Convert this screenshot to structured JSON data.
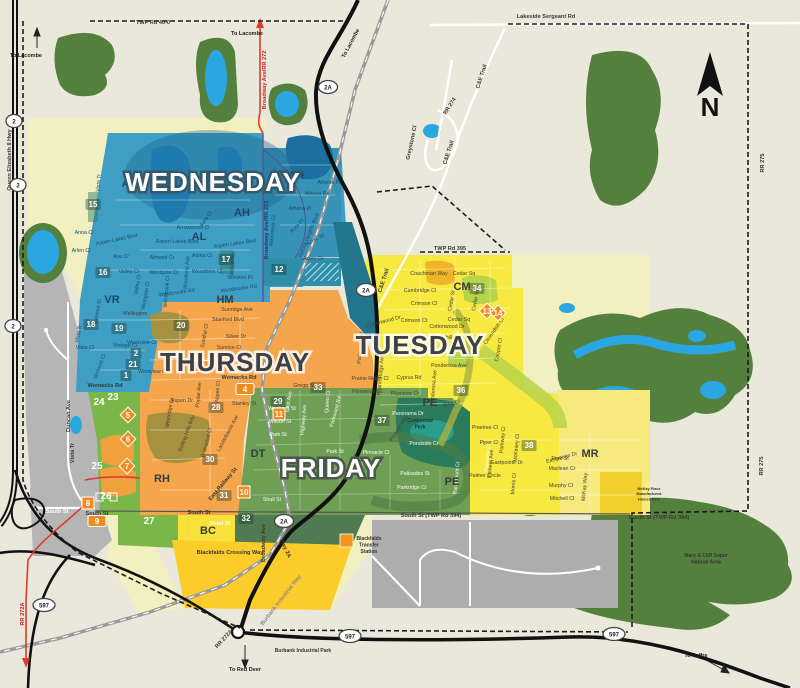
{
  "days": {
    "wednesday": "WEDNESDAY",
    "thursday": "THURSDAY",
    "tuesday": "TUESDAY",
    "friday": "FRIDAY"
  },
  "compass_label": "N",
  "colors": {
    "wednesday_blue": "#3f9ec3",
    "thursday_orange": "#f5a54b",
    "tuesday_yellow": "#f7e93f",
    "friday_green": "#6f9f55",
    "outside_pale": "#f2efc0",
    "county_gray": "#b5b5b5",
    "forest_green": "#54803e",
    "water_blue": "#2aa7e0",
    "marker_orange": "#f28b1f",
    "road_red": "#e03a2f"
  },
  "district_labels": [
    {
      "t": "AL",
      "x": 129,
      "y": 187,
      "c": "navy"
    },
    {
      "t": "AL",
      "x": 199,
      "y": 240,
      "c": "navy"
    },
    {
      "t": "AH",
      "x": 296,
      "y": 179,
      "c": "navy"
    },
    {
      "t": "AH",
      "x": 242,
      "y": 216,
      "c": "navy"
    },
    {
      "t": "VR",
      "x": 112,
      "y": 303,
      "c": "navy"
    },
    {
      "t": "HM",
      "x": 225,
      "y": 303,
      "c": "dark"
    },
    {
      "t": "CM",
      "x": 462,
      "y": 290,
      "c": "dark"
    },
    {
      "t": "RH",
      "x": 162,
      "y": 482,
      "c": "dark"
    },
    {
      "t": "DT",
      "x": 258,
      "y": 457,
      "c": "dark"
    },
    {
      "t": "PE",
      "x": 430,
      "y": 406,
      "c": "dark"
    },
    {
      "t": "PE",
      "x": 452,
      "y": 485,
      "c": "dark"
    },
    {
      "t": "MR",
      "x": 590,
      "y": 457,
      "c": "dark"
    },
    {
      "t": "BC",
      "x": 208,
      "y": 534,
      "c": "dark"
    }
  ],
  "zone_badges": [
    {
      "n": "15",
      "x": 93,
      "y": 207,
      "k": "sq"
    },
    {
      "n": "16",
      "x": 103,
      "y": 275,
      "k": "sq"
    },
    {
      "n": "17",
      "x": 226,
      "y": 262,
      "k": "sq"
    },
    {
      "n": "12",
      "x": 279,
      "y": 272,
      "k": "sq"
    },
    {
      "n": "18",
      "x": 91,
      "y": 327,
      "k": "sq"
    },
    {
      "n": "19",
      "x": 119,
      "y": 331,
      "k": "sq"
    },
    {
      "n": "20",
      "x": 181,
      "y": 328,
      "k": "sq"
    },
    {
      "n": "2",
      "x": 136,
      "y": 356,
      "k": "sq"
    },
    {
      "n": "21",
      "x": 133,
      "y": 367,
      "k": "sq"
    },
    {
      "n": "1",
      "x": 126,
      "y": 378,
      "k": "sq"
    },
    {
      "n": "23",
      "x": 113,
      "y": 400,
      "k": "plain"
    },
    {
      "n": "24",
      "x": 99,
      "y": 405,
      "k": "plain"
    },
    {
      "n": "25",
      "x": 97,
      "y": 469,
      "k": "plain"
    },
    {
      "n": "26",
      "x": 106,
      "y": 499,
      "k": "plain"
    },
    {
      "n": "27",
      "x": 149,
      "y": 524,
      "k": "plain"
    },
    {
      "n": "28",
      "x": 216,
      "y": 410,
      "k": "sq"
    },
    {
      "n": "30",
      "x": 210,
      "y": 462,
      "k": "sq"
    },
    {
      "n": "31",
      "x": 224,
      "y": 498,
      "k": "sq"
    },
    {
      "n": "32",
      "x": 246,
      "y": 521,
      "k": "sq"
    },
    {
      "n": "33",
      "x": 318,
      "y": 390,
      "k": "sq"
    },
    {
      "n": "29",
      "x": 278,
      "y": 404,
      "k": "sq"
    },
    {
      "n": "34",
      "x": 477,
      "y": 291,
      "k": "sq"
    },
    {
      "n": "36",
      "x": 461,
      "y": 393,
      "k": "sq"
    },
    {
      "n": "37",
      "x": 382,
      "y": 423,
      "k": "sq"
    },
    {
      "n": "38",
      "x": 529,
      "y": 448,
      "k": "sq"
    },
    {
      "n": "11",
      "x": 279,
      "y": 417,
      "k": "os"
    },
    {
      "n": "10",
      "x": 244,
      "y": 495,
      "k": "os"
    },
    {
      "n": "8",
      "x": 88,
      "y": 506,
      "k": "os"
    },
    {
      "n": "9",
      "x": 97,
      "y": 524,
      "k": "or"
    },
    {
      "n": "3",
      "x": 202,
      "y": 369,
      "k": "or"
    },
    {
      "n": "4",
      "x": 245,
      "y": 392,
      "k": "or"
    },
    {
      "n": "5",
      "x": 128,
      "y": 418,
      "k": "od"
    },
    {
      "n": "6",
      "x": 128,
      "y": 442,
      "k": "od"
    },
    {
      "n": "7",
      "x": 127,
      "y": 469,
      "k": "od"
    },
    {
      "n": "13",
      "x": 487,
      "y": 314,
      "k": "od"
    },
    {
      "n": "14",
      "x": 498,
      "y": 316,
      "k": "od"
    }
  ],
  "highway_shields": [
    {
      "t": "2",
      "x": 14,
      "y": 123
    },
    {
      "t": "2",
      "x": 18,
      "y": 187
    },
    {
      "t": "2",
      "x": 13,
      "y": 328
    },
    {
      "t": "2A",
      "x": 328,
      "y": 89
    },
    {
      "t": "2A",
      "x": 366,
      "y": 292
    },
    {
      "t": "2A",
      "x": 284,
      "y": 523
    },
    {
      "t": "597",
      "x": 44,
      "y": 607
    },
    {
      "t": "597",
      "x": 350,
      "y": 638
    },
    {
      "t": "597",
      "x": 614,
      "y": 636
    }
  ],
  "road_labels": [
    {
      "t": "TWP Rd 40-0",
      "x": 153,
      "y": 24
    },
    {
      "t": "Lakeside Sergeant Rd",
      "x": 546,
      "y": 18
    },
    {
      "t": "TWP Rd 395",
      "x": 450,
      "y": 250
    },
    {
      "t": "C&E Trail",
      "x": 483,
      "y": 77,
      "r": -72
    },
    {
      "t": "C&E Trail",
      "x": 450,
      "y": 153,
      "r": -72
    },
    {
      "t": "C&E Trail",
      "x": 385,
      "y": 281,
      "r": -72
    },
    {
      "t": "RR 274",
      "x": 451,
      "y": 107,
      "r": -58
    },
    {
      "t": "Greystone Cl",
      "x": 413,
      "y": 143,
      "r": -78
    },
    {
      "t": "RR 275",
      "x": 764,
      "y": 163,
      "r": -90
    },
    {
      "t": "RR 275",
      "x": 763,
      "y": 466,
      "r": -90
    },
    {
      "t": "Queen Elizabeth II Hwy",
      "x": 11,
      "y": 160,
      "r": -90
    },
    {
      "t": "Broadway Ave/RR 272",
      "x": 266,
      "y": 80,
      "r": -90,
      "c": "red"
    },
    {
      "t": "Broadway Ave/RR 272",
      "x": 268,
      "y": 230,
      "r": -90,
      "c": "navy"
    },
    {
      "t": "South St",
      "x": 57,
      "y": 513,
      "c": "white"
    },
    {
      "t": "South St",
      "x": 97,
      "y": 515
    },
    {
      "t": "South St",
      "x": 199,
      "y": 514
    },
    {
      "t": "South St (TWP Rd 394)",
      "x": 431,
      "y": 517
    },
    {
      "t": "South St (TWP Rd 394)",
      "x": 659,
      "y": 519
    },
    {
      "t": "Womacks Rd",
      "x": 239,
      "y": 379
    },
    {
      "t": "Womacks Rd",
      "x": 105,
      "y": 387
    },
    {
      "t": "Hwy 2A",
      "x": 284,
      "y": 549,
      "r": 65
    },
    {
      "t": "Broadway Ave",
      "x": 265,
      "y": 543,
      "r": -90
    },
    {
      "t": "East Railway St",
      "x": 224,
      "y": 485,
      "r": -50
    },
    {
      "t": "Blackfalds Crossing Way",
      "x": 230,
      "y": 554
    },
    {
      "t": "Burbank Industrial Way",
      "x": 282,
      "y": 601,
      "r": -52,
      "c": "gray"
    },
    {
      "t": "RR 272A",
      "x": 24,
      "y": 614,
      "r": -90,
      "c": "red"
    },
    {
      "t": "RR 272A",
      "x": 225,
      "y": 640,
      "r": -48
    },
    {
      "t": "Duncan Ave",
      "x": 70,
      "y": 416,
      "r": -90
    },
    {
      "t": "Vista Tr",
      "x": 74,
      "y": 453,
      "r": -90
    },
    {
      "t": "Trout St",
      "x": 220,
      "y": 525,
      "c": "white"
    }
  ],
  "street_labels": [
    {
      "t": "Vista Tr",
      "x": 100,
      "y": 183,
      "r": -85,
      "c": "b"
    },
    {
      "t": "Vista Tr",
      "x": 80,
      "y": 334,
      "r": -78,
      "c": "b"
    },
    {
      "t": "Anna Cl",
      "x": 84,
      "y": 234,
      "c": "b"
    },
    {
      "t": "Arlen Cl",
      "x": 81,
      "y": 252,
      "c": "b"
    },
    {
      "t": "Ava Cr",
      "x": 121,
      "y": 258,
      "c": "b"
    },
    {
      "t": "Aspen Lakes Blvd",
      "x": 117,
      "y": 241,
      "r": -12,
      "c": "b"
    },
    {
      "t": "Aspen Lakes Blvd",
      "x": 177,
      "y": 243,
      "c": "b"
    },
    {
      "t": "Aspen Lakes Blvd",
      "x": 235,
      "y": 245,
      "r": -8,
      "c": "b"
    },
    {
      "t": "Almond Cr",
      "x": 162,
      "y": 259,
      "c": "b"
    },
    {
      "t": "Adina Cl",
      "x": 202,
      "y": 257,
      "c": "b"
    },
    {
      "t": "Arrowwood Cl",
      "x": 193,
      "y": 229,
      "c": "b"
    },
    {
      "t": "Aura Cl",
      "x": 207,
      "y": 220,
      "r": -55,
      "c": "b"
    },
    {
      "t": "Valley Cr",
      "x": 129,
      "y": 273,
      "c": "b"
    },
    {
      "t": "Valley Cl",
      "x": 139,
      "y": 285,
      "r": -80,
      "c": "b"
    },
    {
      "t": "Westgate Cr",
      "x": 164,
      "y": 274,
      "c": "b"
    },
    {
      "t": "Westgate Cl",
      "x": 147,
      "y": 296,
      "r": -80,
      "c": "b"
    },
    {
      "t": "Woodbine Cl",
      "x": 207,
      "y": 273,
      "c": "b"
    },
    {
      "t": "Woodbine Ave",
      "x": 188,
      "y": 273,
      "r": -85,
      "c": "b"
    },
    {
      "t": "Westbrook Cl",
      "x": 168,
      "y": 292,
      "r": -85,
      "c": "b"
    },
    {
      "t": "Westbrooke Rd",
      "x": 177,
      "y": 294,
      "r": -8,
      "c": "b"
    },
    {
      "t": "Westbrooke Rd",
      "x": 239,
      "y": 290,
      "r": -8,
      "c": "b"
    },
    {
      "t": "Winston Pl",
      "x": 240,
      "y": 279,
      "c": "b"
    },
    {
      "t": "Willow Rd",
      "x": 234,
      "y": 264,
      "r": -85,
      "c": "b"
    },
    {
      "t": "Valmont St",
      "x": 99,
      "y": 312,
      "r": -80,
      "c": "b"
    },
    {
      "t": "Vista Cl",
      "x": 85,
      "y": 349,
      "c": "b"
    },
    {
      "t": "Vintage Cl",
      "x": 125,
      "y": 347,
      "c": "b"
    },
    {
      "t": "Vermont Cl",
      "x": 101,
      "y": 367,
      "r": -70,
      "c": "b"
    },
    {
      "t": "Westview Cr",
      "x": 142,
      "y": 344,
      "c": "b"
    },
    {
      "t": "Westview Cr",
      "x": 153,
      "y": 373,
      "c": "b"
    },
    {
      "t": "Athena Pl",
      "x": 329,
      "y": 184,
      "c": "b"
    },
    {
      "t": "Athena Rd",
      "x": 317,
      "y": 195,
      "c": "b"
    },
    {
      "t": "Athena Pl",
      "x": 300,
      "y": 210,
      "c": "b"
    },
    {
      "t": "Aldermoor Cl",
      "x": 274,
      "y": 231,
      "r": -85,
      "c": "b"
    },
    {
      "t": "Aura Pl",
      "x": 298,
      "y": 227,
      "r": -45,
      "c": "b"
    },
    {
      "t": "Aurora Heights Blvd",
      "x": 310,
      "y": 236,
      "r": -68,
      "c": "b"
    },
    {
      "t": "Aztec St",
      "x": 316,
      "y": 241,
      "r": -30,
      "c": "b"
    },
    {
      "t": "Aztec Cr",
      "x": 313,
      "y": 260,
      "c": "b"
    },
    {
      "t": "Wellington",
      "x": 135,
      "y": 315,
      "c": "d"
    },
    {
      "t": "Sunridge Ave",
      "x": 237,
      "y": 311,
      "c": "d"
    },
    {
      "t": "Stanford Blvd",
      "x": 228,
      "y": 321,
      "c": "d"
    },
    {
      "t": "Silver Dr",
      "x": 236,
      "y": 338,
      "c": "d"
    },
    {
      "t": "Sunrise Cl",
      "x": 229,
      "y": 349,
      "c": "d"
    },
    {
      "t": "Sundial Cl",
      "x": 206,
      "y": 336,
      "r": -80,
      "c": "d"
    },
    {
      "t": "Aspen Dr",
      "x": 182,
      "y": 402,
      "c": "d"
    },
    {
      "t": "Poplar Ave",
      "x": 200,
      "y": 395,
      "r": -85,
      "c": "d"
    },
    {
      "t": "Aspen Cl",
      "x": 219,
      "y": 392,
      "r": -85,
      "c": "d"
    },
    {
      "t": "Rolling Hills Bay",
      "x": 188,
      "y": 434,
      "r": -70,
      "c": "d"
    },
    {
      "t": "Briarwood Cl",
      "x": 208,
      "y": 443,
      "r": -75,
      "c": "d"
    },
    {
      "t": "Landsdowne Ave",
      "x": 229,
      "y": 434,
      "r": -62,
      "c": "d"
    },
    {
      "t": "Westridge Dr",
      "x": 171,
      "y": 413,
      "r": -80,
      "c": "d"
    },
    {
      "t": "Stanley St",
      "x": 244,
      "y": 405,
      "c": "d"
    },
    {
      "t": "Gregg St",
      "x": 304,
      "y": 387,
      "c": "d"
    },
    {
      "t": "East Ave",
      "x": 290,
      "y": 402,
      "r": -80,
      "c": "w"
    },
    {
      "t": "Waghorn St",
      "x": 282,
      "y": 410,
      "c": "w"
    },
    {
      "t": "Wilson St",
      "x": 280,
      "y": 423,
      "c": "w"
    },
    {
      "t": "Park St",
      "x": 278,
      "y": 436,
      "c": "w"
    },
    {
      "t": "Park St",
      "x": 335,
      "y": 453,
      "c": "w"
    },
    {
      "t": "Shull St",
      "x": 272,
      "y": 501,
      "c": "w"
    },
    {
      "t": "Highway Ave",
      "x": 305,
      "y": 420,
      "r": -85,
      "c": "w"
    },
    {
      "t": "Queen Cl",
      "x": 329,
      "y": 402,
      "r": -85,
      "c": "w"
    },
    {
      "t": "Parkwood Rd",
      "x": 337,
      "y": 412,
      "r": -75,
      "c": "w"
    },
    {
      "t": "Panorama Dr",
      "x": 408,
      "y": 415,
      "c": "w"
    },
    {
      "t": "Pinnacle Cl",
      "x": 376,
      "y": 454,
      "c": "w"
    },
    {
      "t": "Portway Cl",
      "x": 368,
      "y": 465,
      "c": "w"
    },
    {
      "t": "Pondside Cr",
      "x": 424,
      "y": 445,
      "c": "w"
    },
    {
      "t": "Palisades St",
      "x": 415,
      "y": 475,
      "c": "w"
    },
    {
      "t": "Parkridge Cr",
      "x": 412,
      "y": 489,
      "c": "w"
    },
    {
      "t": "Paramount Cr",
      "x": 458,
      "y": 478,
      "r": -85,
      "c": "w"
    },
    {
      "t": "Parkview Cl",
      "x": 489,
      "y": 458,
      "r": -85,
      "c": "w"
    },
    {
      "t": "Coachman Way",
      "x": 429,
      "y": 275,
      "c": "d"
    },
    {
      "t": "Cedar Sq",
      "x": 464,
      "y": 275,
      "c": "d"
    },
    {
      "t": "Cedar Sq",
      "x": 459,
      "y": 321,
      "c": "d"
    },
    {
      "t": "Cedar Sq",
      "x": 477,
      "y": 300,
      "r": -80,
      "c": "d"
    },
    {
      "t": "Cedar St",
      "x": 453,
      "y": 301,
      "r": -80,
      "c": "d"
    },
    {
      "t": "Cambridge Cl",
      "x": 420,
      "y": 292,
      "c": "d"
    },
    {
      "t": "Crimson Cl",
      "x": 424,
      "y": 305,
      "c": "d"
    },
    {
      "t": "Crimson Ct",
      "x": 414,
      "y": 322,
      "c": "d"
    },
    {
      "t": "Cottonwood Dr",
      "x": 447,
      "y": 328,
      "c": "d"
    },
    {
      "t": "Cottonwood Dr",
      "x": 384,
      "y": 323,
      "r": -15,
      "c": "d"
    },
    {
      "t": "Churchill Pl",
      "x": 445,
      "y": 339,
      "c": "d"
    },
    {
      "t": "Cavendish Cl",
      "x": 495,
      "y": 332,
      "r": -55,
      "c": "d"
    },
    {
      "t": "Cooper Cl",
      "x": 500,
      "y": 350,
      "r": -80,
      "c": "d"
    },
    {
      "t": "Ponderosa Ave",
      "x": 449,
      "y": 367,
      "c": "d"
    },
    {
      "t": "Ponderosa Ave",
      "x": 435,
      "y": 388,
      "r": -85,
      "c": "d"
    },
    {
      "t": "Cyprus Rd",
      "x": 409,
      "y": 379,
      "c": "d"
    },
    {
      "t": "Plumtree Cr",
      "x": 405,
      "y": 395,
      "c": "d"
    },
    {
      "t": "Pine Cl",
      "x": 452,
      "y": 405,
      "r": -15,
      "c": "d"
    },
    {
      "t": "Prairie Ridge Ave",
      "x": 382,
      "y": 375,
      "r": -85,
      "c": "d"
    },
    {
      "t": "Prairie Ridge Cl",
      "x": 370,
      "y": 380,
      "c": "d"
    },
    {
      "t": "Pinewood Cl",
      "x": 367,
      "y": 393,
      "c": "d"
    },
    {
      "t": "Parkwood Rd",
      "x": 362,
      "y": 348,
      "r": -85,
      "c": "d"
    },
    {
      "t": "Pioneer Way",
      "x": 400,
      "y": 429,
      "r": -58,
      "c": "d"
    },
    {
      "t": "Pinetree Cl",
      "x": 485,
      "y": 429,
      "c": "d"
    },
    {
      "t": "Piper Cl",
      "x": 489,
      "y": 444,
      "c": "d"
    },
    {
      "t": "Parkway Cl",
      "x": 504,
      "y": 440,
      "r": -85,
      "c": "d"
    },
    {
      "t": "Pioneer Ave",
      "x": 492,
      "y": 464,
      "r": -85,
      "c": "d"
    },
    {
      "t": "Eastpointe Dr",
      "x": 507,
      "y": 464,
      "c": "d"
    },
    {
      "t": "Eastpointe Dr",
      "x": 562,
      "y": 459,
      "r": -15,
      "c": "d"
    },
    {
      "t": "Palmer Circle",
      "x": 485,
      "y": 477,
      "c": "d"
    },
    {
      "t": "Morris Cl",
      "x": 515,
      "y": 484,
      "r": -85,
      "c": "d"
    },
    {
      "t": "McKinley Cl",
      "x": 518,
      "y": 448,
      "r": -85,
      "c": "d"
    },
    {
      "t": "Maclean Cr",
      "x": 562,
      "y": 470,
      "c": "d"
    },
    {
      "t": "Murphy Cl",
      "x": 561,
      "y": 487,
      "c": "d"
    },
    {
      "t": "Mitchell Cl",
      "x": 562,
      "y": 500,
      "c": "d"
    },
    {
      "t": "McKay Way",
      "x": 586,
      "y": 487,
      "r": -85,
      "c": "d"
    },
    {
      "t": "Park St",
      "x": 560,
      "y": 460,
      "c": "d"
    }
  ],
  "pois": [
    {
      "lines": [
        "Blackfalds",
        "Transfer",
        "Station"
      ],
      "x": 369,
      "y": 540
    },
    {
      "lines": [
        "Burbank Industrial Park"
      ],
      "x": 303,
      "y": 652
    },
    {
      "lines": [
        "Mary & Cliff Soper",
        "Natural Area"
      ],
      "x": 706,
      "y": 557,
      "c": "white"
    },
    {
      "lines": [
        "Centennial",
        "Park"
      ],
      "x": 420,
      "y": 422,
      "c": "teal"
    },
    {
      "lines": [
        "McKay Place",
        "Manufactured",
        "Homes Park"
      ],
      "x": 649,
      "y": 490,
      "size": 3.8
    }
  ],
  "directions": [
    {
      "t": "To Lacombe",
      "x": 26,
      "y": 57
    },
    {
      "t": "To Lacombe",
      "x": 247,
      "y": 35
    },
    {
      "t": "To Lacombe",
      "x": 352,
      "y": 44,
      "r": -62
    },
    {
      "t": "To Red Deer",
      "x": 245,
      "y": 671
    },
    {
      "t": "To Joffre",
      "x": 696,
      "y": 657
    }
  ]
}
